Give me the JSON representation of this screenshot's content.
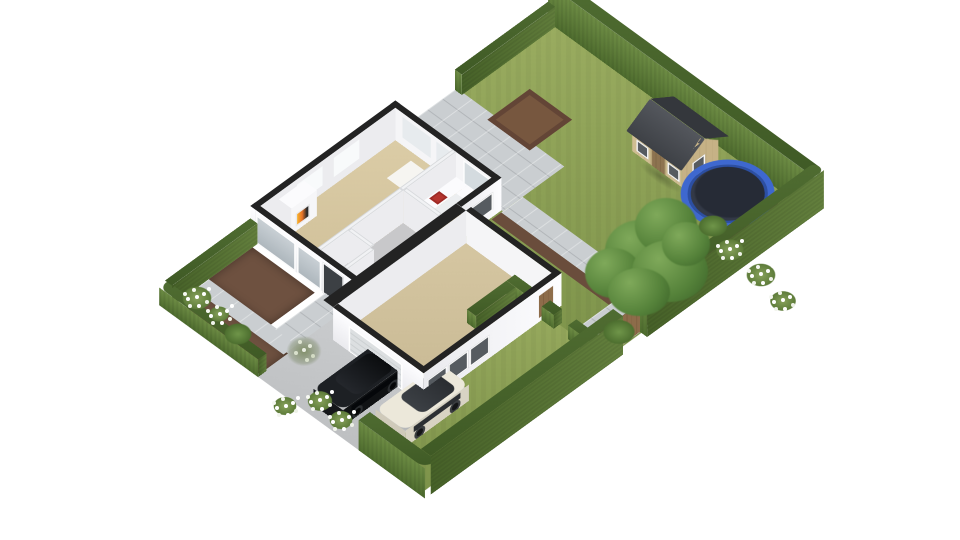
{
  "scene": {
    "title": "3D isometric floor-plan render of a detached house with front and back garden",
    "view": "isometric aerial render on white background",
    "background_color": "#ffffff",
    "labels": {
      "plot": "Hedged garden plot",
      "hedge": "Boundary hedge",
      "back_lawn": "Back garden lawn",
      "side_lawn": "Side lawn strip",
      "patio": "Tiled stone patio",
      "path_back": "Tiled path to side gate",
      "veg_patch": "Bare soil patch",
      "flower_border": "Soil flower border with white blooms",
      "shed": "Wooden garden shed with dark gabled roof",
      "trampoline": "Blue-rimmed trampoline",
      "tree": "Large garden tree",
      "low_hedge": "Low clipped hedge divider",
      "gate": "Wooden garden gate",
      "house": "Single-storey house shown as cutaway floor plan",
      "living_room": "Open-plan living and dining room with fireplace and white rug",
      "fireplace": "White fireplace with lit fire",
      "kitchen": "Kitchen with L-shaped white counter and red hob",
      "stairs": "Staircase",
      "wc": "WC with toilet",
      "garage": "Garage / extension room with windows",
      "driveway": "Concrete driveway",
      "black_car": "Black SUV parked on driveway",
      "white_car": "White SUV parked on driveway",
      "front_beds": "Front garden soil beds with shrubs and white flowers",
      "front_path": "Front garden paths"
    },
    "palette": {
      "lawn": "#8aa050",
      "hedge_top": "#4a662e",
      "hedge_side": "#617f3b",
      "patio_tile": "#caced1",
      "driveway": "#c5c7c9",
      "soil": "#6e5140",
      "floor_carpet": "#d8c8a2",
      "wall_white": "#fafafc",
      "wall_cut_top": "#232323",
      "shed_wood": "#c9b78c",
      "shed_roof": "#45484e",
      "trampoline_rim": "#3e68cf",
      "trampoline_mat": "#262b36",
      "car_black": "#1c1f23",
      "car_white": "#ece8da",
      "fire": "#e8742a",
      "hob": "#b5342e",
      "gate_wood": "#8a6b4a"
    },
    "objects": [
      "boundary hedges",
      "back lawn",
      "tiled patio",
      "garden paths",
      "soil patch",
      "wooden shed",
      "trampoline",
      "large tree",
      "flower borders",
      "low hedge dividers",
      "wooden gate",
      "cutaway house with fireplace, kitchen, stairs, WC, garage",
      "concrete driveway",
      "black SUV",
      "white SUV",
      "front flower beds"
    ]
  }
}
